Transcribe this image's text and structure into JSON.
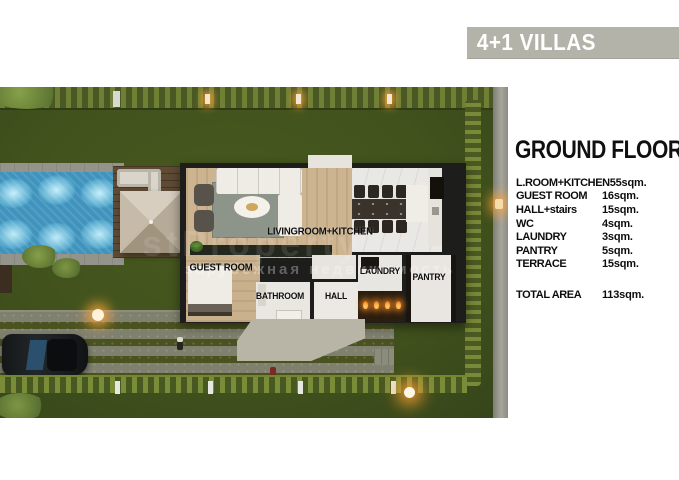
{
  "banner": {
    "title": "4+1 VILLAS",
    "bg": "#b4b3a9",
    "fg": "#ffffff"
  },
  "panel": {
    "title": "GROUND FLOOR",
    "rows": [
      {
        "label": "L.ROOM+KITCHEN",
        "value": "55sqm."
      },
      {
        "label": "GUEST ROOM",
        "value": "16sqm."
      },
      {
        "label": "HALL+stairs",
        "value": "15sqm."
      },
      {
        "label": "WC",
        "value": "4sqm."
      },
      {
        "label": "LAUNDRY",
        "value": "3sqm."
      },
      {
        "label": "PANTRY",
        "value": "5sqm."
      },
      {
        "label": "TERRACE",
        "value": "15sqm."
      }
    ],
    "total": {
      "label": "TOTAL AREA",
      "value": "113sqm."
    }
  },
  "plan": {
    "labels": {
      "living": "LIVINGROOM+KITCHEN",
      "guest": "GUEST ROOM",
      "bathroom": "BATHROOM",
      "hall": "HALL",
      "laundry": "LAUNDRY",
      "pantry": "PANTRY"
    },
    "watermark": {
      "brand": "stProperty",
      "tagline": "зарубежная недвижимость"
    }
  },
  "colors": {
    "lawn": "#42541f",
    "pool": "#45a0c6",
    "flame": "#ff9a2e",
    "building_wall": "#1d1d1b"
  }
}
